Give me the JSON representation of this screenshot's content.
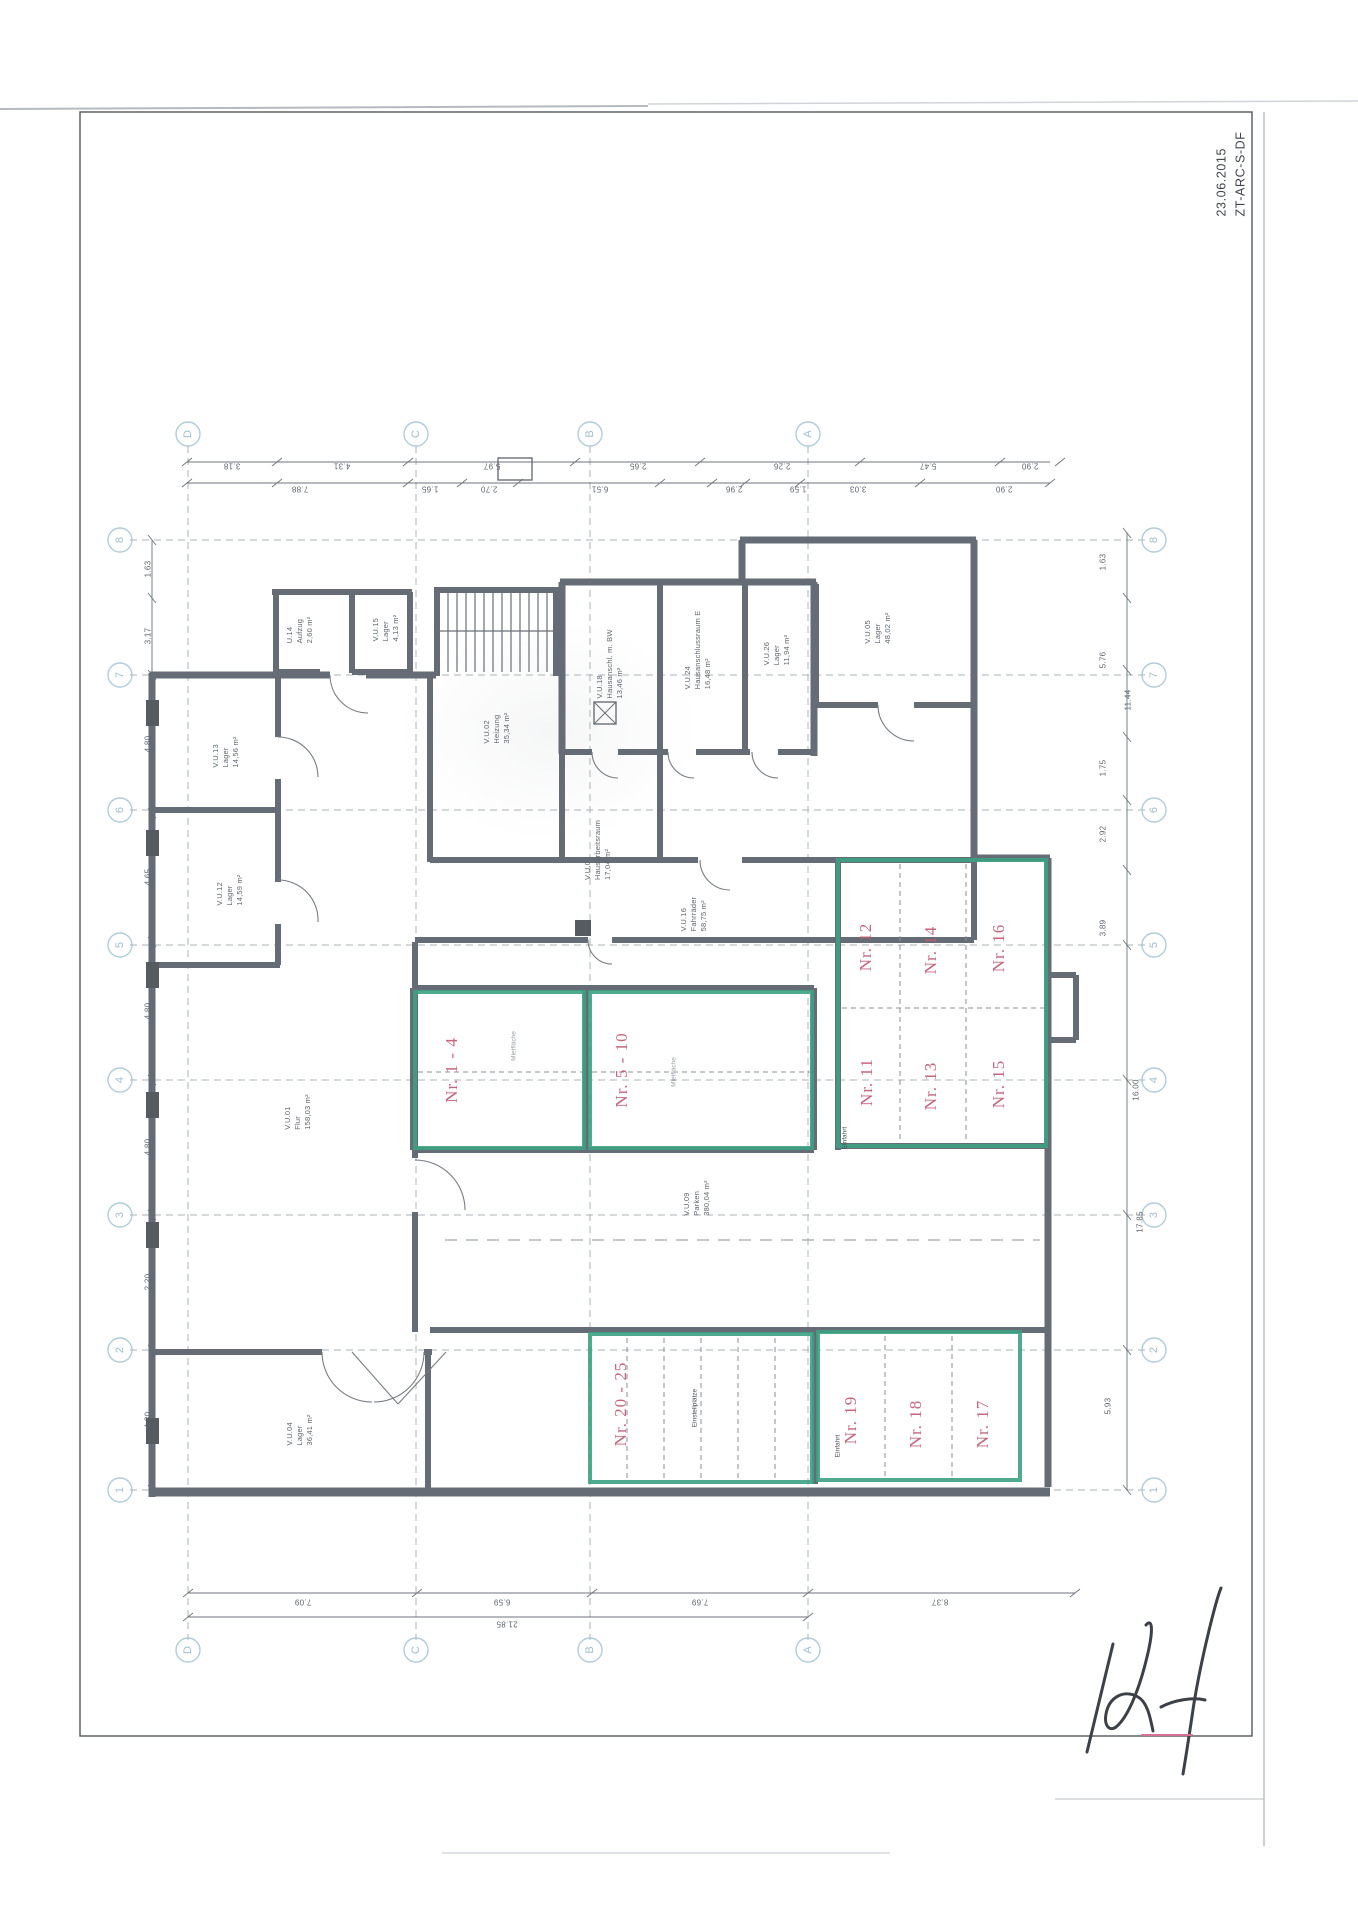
{
  "stamp": {
    "date": "23.06.2015",
    "code": "ZT-ARC-S-DF"
  },
  "plan": {
    "colors": {
      "unit_red": "#c05b72",
      "highlight_green": "#3da183",
      "wall_gray": "#666c75",
      "grid_blue": "#a6c3d2"
    },
    "units": [
      {
        "label": "Nr. 1 - 4",
        "x": 452,
        "y": 1070
      },
      {
        "label": "Nr. 5 - 10",
        "x": 622,
        "y": 1070
      },
      {
        "label": "Nr. 12",
        "x": 866,
        "y": 947
      },
      {
        "label": "Nr. 14",
        "x": 931,
        "y": 950
      },
      {
        "label": "Nr. 16",
        "x": 999,
        "y": 948
      },
      {
        "label": "Nr. 11",
        "x": 867,
        "y": 1082
      },
      {
        "label": "Nr. 13",
        "x": 931,
        "y": 1086
      },
      {
        "label": "Nr. 15",
        "x": 999,
        "y": 1084
      },
      {
        "label": "Nr. 20 - 25",
        "x": 621,
        "y": 1404
      },
      {
        "label": "Nr. 19",
        "x": 851,
        "y": 1420
      },
      {
        "label": "Nr. 18",
        "x": 916,
        "y": 1424
      },
      {
        "label": "Nr. 17",
        "x": 983,
        "y": 1424
      }
    ],
    "rooms": [
      {
        "lines": [
          "U.14",
          "Aufzug",
          "2,60 m²"
        ],
        "x": 300,
        "y": 630
      },
      {
        "lines": [
          "V.U.15",
          "Lager",
          "4,13 m²"
        ],
        "x": 386,
        "y": 628
      },
      {
        "lines": [
          "V.U.18",
          "Hausanschl. m. BW",
          "13,46 m²"
        ],
        "x": 610,
        "y": 664
      },
      {
        "lines": [
          "V.U.24",
          "Hausanschlussraum E",
          "16,48 m²"
        ],
        "x": 698,
        "y": 650
      },
      {
        "lines": [
          "V.U.26",
          "Lager",
          "11,94 m²"
        ],
        "x": 777,
        "y": 650
      },
      {
        "lines": [
          "V.U.05",
          "Lager",
          "48,02 m²"
        ],
        "x": 878,
        "y": 628
      },
      {
        "lines": [
          "V.U.02",
          "Heizung",
          "35,34 m²"
        ],
        "x": 497,
        "y": 728
      },
      {
        "lines": [
          "V.U.13",
          "Lager",
          "14,56 m²"
        ],
        "x": 226,
        "y": 752
      },
      {
        "lines": [
          "V.U.12",
          "Lager",
          "14,59 m²"
        ],
        "x": 230,
        "y": 890
      },
      {
        "lines": [
          "V.U.07",
          "Hausarbeitsraum",
          "17,04 m²"
        ],
        "x": 598,
        "y": 850
      },
      {
        "lines": [
          "V.U.16",
          "Fahrräder",
          "58,75 m²"
        ],
        "x": 694,
        "y": 914
      },
      {
        "lines": [
          "V.U.01",
          "Flur",
          "158,03 m²"
        ],
        "x": 298,
        "y": 1112
      },
      {
        "lines": [
          "V.U.09",
          "Parken",
          "380,04 m²"
        ],
        "x": 697,
        "y": 1198
      },
      {
        "lines": [
          "V.U.04",
          "Lager",
          "36,41 m²"
        ],
        "x": 300,
        "y": 1430
      }
    ],
    "notes": [
      {
        "text": "Einfahrt",
        "x": 845,
        "y": 1138,
        "faint": false
      },
      {
        "text": "Einstellplätze",
        "x": 695,
        "y": 1408,
        "faint": false
      },
      {
        "text": "Einfahrt",
        "x": 838,
        "y": 1446,
        "faint": false
      },
      {
        "text": "Mietfläche",
        "x": 514,
        "y": 1046,
        "faint": true
      },
      {
        "text": "Mietfläche",
        "x": 674,
        "y": 1072,
        "faint": true
      }
    ],
    "grid": {
      "col_top_y": 434,
      "col_bottom_y": 1650,
      "row_left_x": 120,
      "row_right_x": 1154,
      "cols": [
        {
          "label": "D",
          "x": 188
        },
        {
          "label": "C",
          "x": 416
        },
        {
          "label": "B",
          "x": 590
        },
        {
          "label": "A",
          "x": 808
        }
      ],
      "rows": [
        {
          "label": "8",
          "y": 540
        },
        {
          "label": "7",
          "y": 675
        },
        {
          "label": "6",
          "y": 810
        },
        {
          "label": "5",
          "y": 945
        },
        {
          "label": "4",
          "y": 1080
        },
        {
          "label": "3",
          "y": 1215
        },
        {
          "label": "2",
          "y": 1350
        },
        {
          "label": "1",
          "y": 1490
        }
      ]
    },
    "dims": {
      "left": [
        {
          "v": "1.63",
          "x": 148,
          "y": 569
        },
        {
          "v": "3.17",
          "x": 148,
          "y": 636
        },
        {
          "v": "4.80",
          "x": 148,
          "y": 744
        },
        {
          "v": "4.65",
          "x": 148,
          "y": 877
        },
        {
          "v": "4.80",
          "x": 148,
          "y": 1011
        },
        {
          "v": "4.80",
          "x": 148,
          "y": 1147
        },
        {
          "v": "2.20",
          "x": 148,
          "y": 1282
        },
        {
          "v": "4.80",
          "x": 148,
          "y": 1420
        }
      ],
      "right": [
        {
          "v": "1.63",
          "x": 1103,
          "y": 562
        },
        {
          "v": "5.76",
          "x": 1103,
          "y": 660
        },
        {
          "v": "11.44",
          "x": 1128,
          "y": 700
        },
        {
          "v": "1.75",
          "x": 1103,
          "y": 768
        },
        {
          "v": "2.92",
          "x": 1103,
          "y": 834
        },
        {
          "v": "3.89",
          "x": 1103,
          "y": 928
        },
        {
          "v": "16.00",
          "x": 1136,
          "y": 1090
        },
        {
          "v": "17.85",
          "x": 1140,
          "y": 1222
        },
        {
          "v": "5.93",
          "x": 1108,
          "y": 1406
        }
      ],
      "top_row1": [
        {
          "v": "3.18",
          "x": 232,
          "y": 466
        },
        {
          "v": "4.31",
          "x": 342,
          "y": 466
        },
        {
          "v": "5.97",
          "x": 492,
          "y": 466
        },
        {
          "v": "2.65",
          "x": 638,
          "y": 466
        },
        {
          "v": "2.26",
          "x": 782,
          "y": 466
        },
        {
          "v": "5.47",
          "x": 928,
          "y": 466
        },
        {
          "v": "2.90",
          "x": 1030,
          "y": 466
        }
      ],
      "top_row2": [
        {
          "v": "7.88",
          "x": 300,
          "y": 489
        },
        {
          "v": "1.65",
          "x": 430,
          "y": 489
        },
        {
          "v": "2.70",
          "x": 489,
          "y": 489
        },
        {
          "v": "6.51",
          "x": 600,
          "y": 489
        },
        {
          "v": "2.96",
          "x": 734,
          "y": 489
        },
        {
          "v": "1.59",
          "x": 798,
          "y": 489
        },
        {
          "v": "3.03",
          "x": 858,
          "y": 489
        },
        {
          "v": "2.90",
          "x": 1004,
          "y": 489
        }
      ],
      "bottom_row1": [
        {
          "v": "7.09",
          "x": 303,
          "y": 1602
        },
        {
          "v": "6.59",
          "x": 502,
          "y": 1602
        },
        {
          "v": "7.69",
          "x": 700,
          "y": 1602
        },
        {
          "v": "8.37",
          "x": 940,
          "y": 1602
        }
      ],
      "bottom_row2": [
        {
          "v": "21.85",
          "x": 507,
          "y": 1624
        }
      ]
    }
  }
}
